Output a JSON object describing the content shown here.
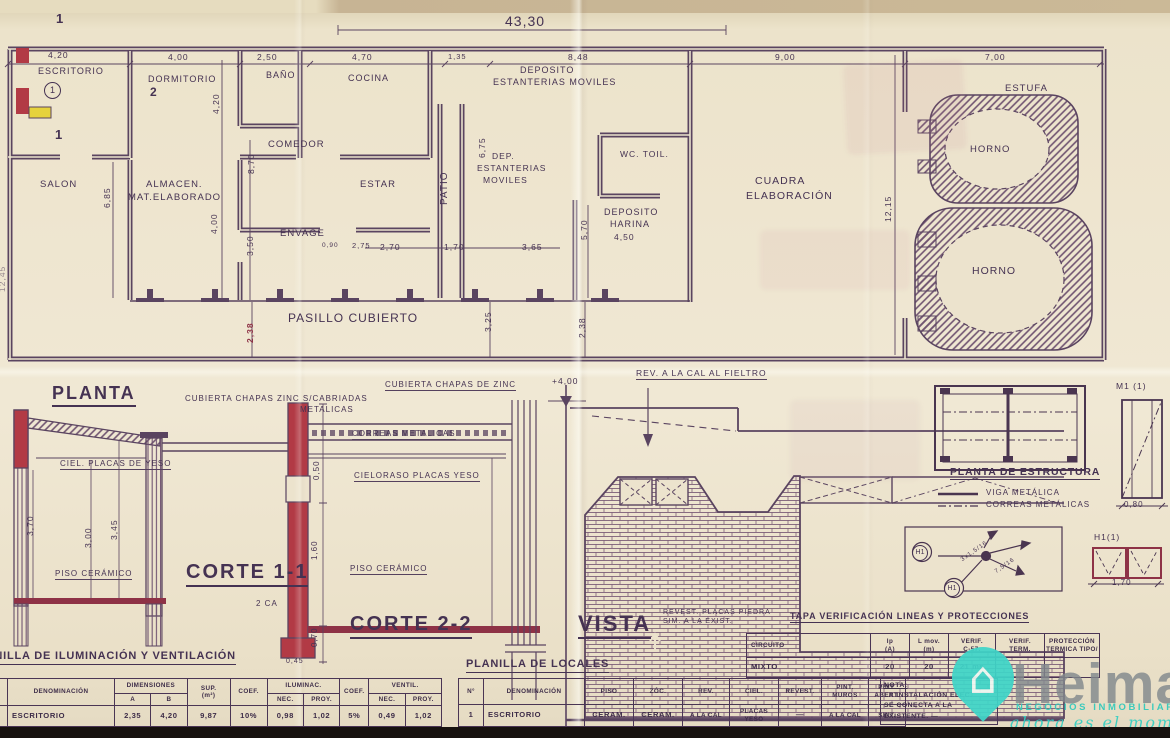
{
  "colors": {
    "ink": "#4a3550",
    "red": "#b23a45",
    "floor_red": "#8e3246",
    "yellow": "#e6d23c",
    "teal": "#3fd5c8",
    "paper": "#ece3cd"
  },
  "labels": [
    {
      "n": "dim-total-width",
      "t": "43,30",
      "x": 505,
      "y": 14,
      "fs": 14
    },
    {
      "n": "dim-escritorio",
      "t": "4,20",
      "x": 48,
      "y": 51,
      "fs": 8.5
    },
    {
      "n": "dim-dormitorio",
      "t": "4,00",
      "x": 168,
      "y": 53,
      "fs": 8.5
    },
    {
      "n": "dim-banio",
      "t": "2,50",
      "x": 257,
      "y": 53,
      "fs": 8.5
    },
    {
      "n": "dim-cocina",
      "t": "4,70",
      "x": 352,
      "y": 53,
      "fs": 8.5
    },
    {
      "n": "dim-135",
      "t": "1,35",
      "x": 448,
      "y": 53,
      "fs": 7.5
    },
    {
      "n": "dim-deposito",
      "t": "8,48",
      "x": 568,
      "y": 53,
      "fs": 8.5
    },
    {
      "n": "dim-cuadra",
      "t": "9,00",
      "x": 775,
      "y": 53,
      "fs": 8.5
    },
    {
      "n": "dim-estufa",
      "t": "7,00",
      "x": 985,
      "y": 53,
      "fs": 8.5
    },
    {
      "n": "room-escritorio",
      "t": "ESCRITORIO",
      "x": 38,
      "y": 67,
      "fs": 9
    },
    {
      "n": "room-number-1",
      "t": "1",
      "x": 44,
      "y": 82,
      "fs": 9,
      "c": "circle"
    },
    {
      "n": "room-dormitorio",
      "t": "DORMITORIO",
      "x": 148,
      "y": 75,
      "fs": 9
    },
    {
      "n": "room-banio",
      "t": "BAÑO",
      "x": 266,
      "y": 71,
      "fs": 9
    },
    {
      "n": "room-cocina",
      "t": "COCINA",
      "x": 348,
      "y": 74,
      "fs": 9
    },
    {
      "n": "room-deposito-line1",
      "t": "DEPOSITO",
      "x": 520,
      "y": 66,
      "fs": 9
    },
    {
      "n": "room-deposito-line2",
      "t": "ESTANTERIAS MOVILES",
      "x": 493,
      "y": 78,
      "fs": 9
    },
    {
      "n": "room-salon",
      "t": "SALON",
      "x": 40,
      "y": 180,
      "fs": 9.5
    },
    {
      "n": "room-almacen-line1",
      "t": "ALMACEN.",
      "x": 146,
      "y": 180,
      "fs": 9.5
    },
    {
      "n": "room-almacen-line2",
      "t": "MAT.ELABORADO",
      "x": 128,
      "y": 193,
      "fs": 9.5
    },
    {
      "n": "room-comedor",
      "t": "COMEDOR",
      "x": 268,
      "y": 140,
      "fs": 9.5
    },
    {
      "n": "room-estar",
      "t": "ESTAR",
      "x": 360,
      "y": 180,
      "fs": 9.5
    },
    {
      "n": "room-patio",
      "t": "PATIO",
      "x": 440,
      "y": 205,
      "fs": 10,
      "r": -90
    },
    {
      "n": "room-dep-line1",
      "t": "DEP.",
      "x": 492,
      "y": 152,
      "fs": 8.5
    },
    {
      "n": "room-dep-line2",
      "t": "ESTANTERIAS",
      "x": 477,
      "y": 164,
      "fs": 8.5
    },
    {
      "n": "room-dep-line3",
      "t": "MOVILES",
      "x": 483,
      "y": 176,
      "fs": 8.5
    },
    {
      "n": "room-wc-toil",
      "t": "WC.  TOIL.",
      "x": 620,
      "y": 150,
      "fs": 8.5
    },
    {
      "n": "room-harina-line1",
      "t": "DEPOSITO",
      "x": 604,
      "y": 208,
      "fs": 9
    },
    {
      "n": "room-harina-line2",
      "t": "HARINA",
      "x": 610,
      "y": 220,
      "fs": 9
    },
    {
      "n": "dim-harina",
      "t": "4,50",
      "x": 614,
      "y": 233,
      "fs": 8.5
    },
    {
      "n": "room-envage",
      "t": "ENVAGE",
      "x": 280,
      "y": 229,
      "fs": 9.5
    },
    {
      "n": "room-pasillo-cubierto",
      "t": "PASILLO  CUBIERTO",
      "x": 288,
      "y": 312,
      "fs": 12
    },
    {
      "n": "room-cuadra-line1",
      "t": "CUADRA",
      "x": 755,
      "y": 176,
      "fs": 10.5
    },
    {
      "n": "room-cuadra-line2",
      "t": "ELABORACIÓN",
      "x": 746,
      "y": 191,
      "fs": 10.5
    },
    {
      "n": "room-estufa",
      "t": "ESTUFA",
      "x": 1005,
      "y": 84,
      "fs": 9.5
    },
    {
      "n": "room-horno-upper",
      "t": "HORNO",
      "x": 970,
      "y": 145,
      "fs": 9.5
    },
    {
      "n": "room-horno-lower",
      "t": "HORNO",
      "x": 972,
      "y": 266,
      "fs": 10.5
    },
    {
      "n": "dim-1215",
      "t": "12,15",
      "x": 884,
      "y": 222,
      "fs": 8.5,
      "r": -90
    },
    {
      "n": "dim-685",
      "t": "6,85",
      "x": 103,
      "y": 208,
      "fs": 8.5,
      "r": -90
    },
    {
      "n": "dim-420v",
      "t": "4,20",
      "x": 212,
      "y": 114,
      "fs": 8.5,
      "r": -90
    },
    {
      "n": "dim-870",
      "t": "8,70",
      "x": 247,
      "y": 174,
      "fs": 8.5,
      "r": -90
    },
    {
      "n": "dim-400v",
      "t": "4,00",
      "x": 210,
      "y": 234,
      "fs": 8.5,
      "r": -90
    },
    {
      "n": "dim-350",
      "t": "3,50",
      "x": 246,
      "y": 256,
      "fs": 8.5,
      "r": -90
    },
    {
      "n": "dim-675",
      "t": "6,75",
      "x": 478,
      "y": 158,
      "fs": 8.5,
      "r": -90
    },
    {
      "n": "dim-570",
      "t": "5,70",
      "x": 580,
      "y": 240,
      "fs": 8.5,
      "r": -90
    },
    {
      "n": "dim-270",
      "t": "2,70",
      "x": 380,
      "y": 243,
      "fs": 8.5
    },
    {
      "n": "dim-170",
      "t": "1,70",
      "x": 444,
      "y": 243,
      "fs": 8.5
    },
    {
      "n": "dim-365",
      "t": "3,65",
      "x": 522,
      "y": 243,
      "fs": 8.5
    },
    {
      "n": "dim-090",
      "t": "0,90",
      "x": 322,
      "y": 243,
      "fs": 6.5
    },
    {
      "n": "dim-275",
      "t": "2,75",
      "x": 352,
      "y": 242,
      "fs": 7.5
    },
    {
      "n": "dim-325",
      "t": "3,25",
      "x": 484,
      "y": 332,
      "fs": 8.5,
      "r": -90
    },
    {
      "n": "dim-238-left",
      "t": "2,38",
      "x": 246,
      "y": 343,
      "fs": 8.5,
      "r": -90,
      "c": "red-dim"
    },
    {
      "n": "dim-238-right",
      "t": "2,38",
      "x": 578,
      "y": 338,
      "fs": 8.5,
      "r": -90
    },
    {
      "n": "dim-1245-edge",
      "t": "12,45",
      "x": -2,
      "y": 292,
      "fs": 8.5,
      "r": -90,
      "c": "faded"
    },
    {
      "n": "cut-marker-1a",
      "t": "1",
      "x": 56,
      "y": 12,
      "fs": 13,
      "c": "bold"
    },
    {
      "n": "cut-marker-2",
      "t": "2",
      "x": 150,
      "y": 86,
      "fs": 12,
      "c": "bold"
    },
    {
      "n": "cut-marker-1b",
      "t": "1",
      "x": 55,
      "y": 128,
      "fs": 13,
      "c": "bold"
    },
    {
      "n": "title-planta",
      "t": "PLANTA",
      "x": 52,
      "y": 384,
      "fs": 18,
      "c": "title"
    },
    {
      "n": "note-cubierta-cabriadas-1",
      "t": "CUBIERTA CHAPAS ZINC S/CABRIADAS",
      "x": 185,
      "y": 395,
      "fs": 8
    },
    {
      "n": "note-cubierta-cabriadas-2",
      "t": "METALICAS",
      "x": 300,
      "y": 406,
      "fs": 8
    },
    {
      "n": "note-ciel-placas-yeso",
      "t": "CIEL. PLACAS DE YESO",
      "x": 60,
      "y": 460,
      "fs": 8,
      "c": "u"
    },
    {
      "n": "dim-370",
      "t": "3,70",
      "x": 26,
      "y": 536,
      "fs": 8.5,
      "r": -90
    },
    {
      "n": "dim-300",
      "t": "3,00",
      "x": 84,
      "y": 548,
      "fs": 8.5,
      "r": -90
    },
    {
      "n": "dim-345",
      "t": "3,45",
      "x": 110,
      "y": 540,
      "fs": 8.5,
      "r": -90
    },
    {
      "n": "note-piso-ceramico-1",
      "t": "PISO CERÁMICO",
      "x": 55,
      "y": 570,
      "fs": 8,
      "c": "u"
    },
    {
      "n": "title-corte-1-1",
      "t": "CORTE 1-1",
      "x": 186,
      "y": 562,
      "fs": 20,
      "c": "title"
    },
    {
      "n": "note-cubierta-zinc",
      "t": "CUBIERTA CHAPAS DE ZINC",
      "x": 385,
      "y": 381,
      "fs": 8,
      "c": "u"
    },
    {
      "n": "note-correas-metalicas",
      "t": "CORREAS METALICAS",
      "x": 352,
      "y": 430,
      "fs": 8,
      "c": "u"
    },
    {
      "n": "note-cieloraso",
      "t": "CIELORASO PLACAS YESO",
      "x": 354,
      "y": 472,
      "fs": 8,
      "c": "u"
    },
    {
      "n": "dim-050",
      "t": "0,50",
      "x": 313,
      "y": 480,
      "fs": 8,
      "r": -90
    },
    {
      "n": "dim-160",
      "t": "1,60",
      "x": 311,
      "y": 560,
      "fs": 8,
      "r": -90
    },
    {
      "n": "note-piso-ceramico-2",
      "t": "PISO CERÁMICO",
      "x": 350,
      "y": 565,
      "fs": 8,
      "c": "u"
    },
    {
      "n": "dim-070",
      "t": "0,70",
      "x": 311,
      "y": 647,
      "fs": 8,
      "r": -90
    },
    {
      "n": "title-corte-2-2",
      "t": "CORTE 2-2",
      "x": 350,
      "y": 614,
      "fs": 20,
      "c": "title"
    },
    {
      "n": "note-2ca",
      "t": "2 CA",
      "x": 256,
      "y": 600,
      "fs": 8
    },
    {
      "n": "dim-045",
      "t": "0,45",
      "x": 286,
      "y": 658,
      "fs": 7
    },
    {
      "n": "level-mark-400",
      "t": "+4,00",
      "x": 552,
      "y": 377,
      "fs": 8.5
    },
    {
      "n": "note-rev-cal-fieltro",
      "t": "REV. A LA CAL AL FIELTRO",
      "x": 636,
      "y": 369,
      "fs": 8.5,
      "c": "u"
    },
    {
      "n": "title-vista",
      "t": "VISTA",
      "x": 578,
      "y": 612,
      "fs": 22,
      "c": "title"
    },
    {
      "n": "note-revest-piedra-1",
      "t": "REVEST. PLACAS PIEDRA",
      "x": 663,
      "y": 609,
      "fs": 7
    },
    {
      "n": "note-revest-piedra-2",
      "t": "SIM. A LA EXIST.",
      "x": 663,
      "y": 618,
      "fs": 7
    },
    {
      "n": "title-tapa-verificacion",
      "t": "TAPA VERIFICACIÓN LINEAS Y PROTECCIONES",
      "x": 790,
      "y": 612,
      "fs": 9,
      "c": "title-sm"
    },
    {
      "n": "title-planta-estructura",
      "t": "PLANTA DE ESTRUCTURA",
      "x": 950,
      "y": 467,
      "fs": 10.5,
      "c": "title-sm"
    },
    {
      "n": "legend-viga-metalica",
      "t": "VIGA METÁLICA",
      "x": 986,
      "y": 489,
      "fs": 8
    },
    {
      "n": "legend-correas-metalicas",
      "t": "CORREAS METÁLICAS",
      "x": 986,
      "y": 501,
      "fs": 8
    },
    {
      "n": "label-m1-1",
      "t": "M1 (1)",
      "x": 1116,
      "y": 382,
      "fs": 8.5
    },
    {
      "n": "dim-080",
      "t": "0,80",
      "x": 1124,
      "y": 501,
      "fs": 8
    },
    {
      "n": "label-h1-1",
      "t": "H1(1)",
      "x": 1094,
      "y": 533,
      "fs": 8.5
    },
    {
      "n": "dim-170-detail",
      "t": "1,70",
      "x": 1112,
      "y": 579,
      "fs": 8
    },
    {
      "n": "badge-h1-a",
      "t": "H1",
      "x": 912,
      "y": 545,
      "fs": 7,
      "c": "circle-sm"
    },
    {
      "n": "badge-h1-b",
      "t": "H1",
      "x": 944,
      "y": 581,
      "fs": 7,
      "c": "circle-sm"
    },
    {
      "n": "wire-label-a",
      "t": "3x1,5/16",
      "x": 960,
      "y": 558,
      "fs": 6,
      "r": -35
    },
    {
      "n": "wire-label-b",
      "t": "7,5/16",
      "x": 994,
      "y": 570,
      "fs": 6,
      "r": -35
    },
    {
      "n": "title-planilla-iluminacion",
      "t": "PLANILLA DE ILUMINACIÓN Y VENTILACIÓN",
      "x": -30,
      "y": 651,
      "fs": 11,
      "c": "title-sm"
    },
    {
      "n": "title-planilla-locales",
      "t": "PLANILLA DE LOCALES",
      "x": 466,
      "y": 659,
      "fs": 11,
      "c": "title-sm"
    }
  ],
  "tables": {
    "ilum": {
      "h_den": "DENOMINACIÓN",
      "h_dim": "DIMENSIONES",
      "h_a": "A",
      "h_b": "B",
      "h_sup1": "SUP.",
      "h_sup2": "(m²)",
      "h_coef": "COEF.",
      "h_ilum": "ILUMINAC.",
      "h_nec": "NEC.",
      "h_proy": "PROY.",
      "h_coef2": "COEF.",
      "h_vent": "VENTIL.",
      "h_nec2": "NEC.",
      "h_proy2": "PROY.",
      "row": {
        "den": "ESCRITORIO",
        "a": "2,35",
        "b": "4,20",
        "sup": "9,87",
        "coef": "10%",
        "nec": "0,98",
        "proy": "1,02",
        "coef2": "5%",
        "nec2": "0,49",
        "proy2": "1,02"
      }
    },
    "locales": {
      "h_n": "N°",
      "h_den": "DENOMINACIÓN",
      "h_piso": "PISO",
      "h_zoc": "ZÓC.",
      "h_rev": "REV.",
      "h_ciel": "CIEL.",
      "h_revest": "REVEST.",
      "h_pm": "PINT. MUROS",
      "h_pa": "PINT. ABERT.",
      "row": {
        "n": "1",
        "den": "ESCRITORIO",
        "piso": "CERAM.",
        "zoc": "CERAM.",
        "rev": "A LA CAL",
        "ciel": "PLACAS YESO",
        "revest": "—",
        "pm": "A LA CAL",
        "pa": "SINT."
      }
    },
    "tapa": {
      "h_circuito": "CIRCUITO",
      "h_ip1": "Ip",
      "h_ip2": "(A)",
      "h_lmov1": "L mov.",
      "h_lmov2": "(m)",
      "h_verif1": "VERIF.",
      "h_verif2": "C-57.",
      "h_vterm1": "VERIF.",
      "h_vterm2": "TERM.",
      "h_prot1": "PROTECCIÓN",
      "h_prot2": "TERMICA TIPO/",
      "row": {
        "circuito": "MIXTO",
        "ip": "20",
        "lmov": "20",
        "verif": "21 ms",
        "vterm": "",
        "prot": ""
      }
    }
  },
  "nota": {
    "title": "NOTA:",
    "l1": "LA INSTALACIÓN ELEC.",
    "l2": "SE CONECTA A LA",
    "l3": "EXISTENTE. —"
  },
  "logo": {
    "brand": "Heima",
    "tagline": "NEGOCIOS INMOBILIARIO",
    "script": "ahora es el momento",
    "house_glyph": "⌂"
  }
}
